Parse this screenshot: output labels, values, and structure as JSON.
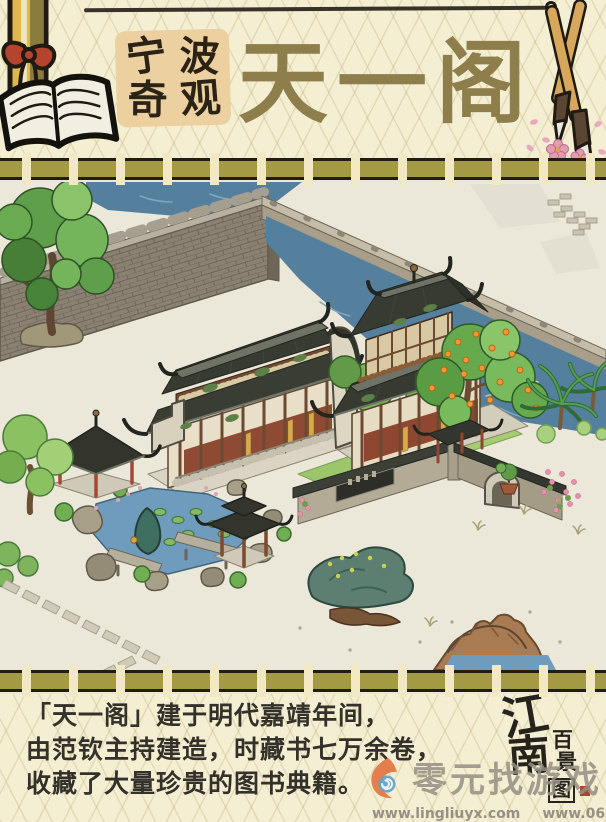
{
  "header": {
    "badge": {
      "label": "宁波奇观",
      "chars": [
        "宁",
        "波",
        "奇",
        "观"
      ],
      "bg": "#ecd0a0"
    },
    "title": "天一阁",
    "title_color": "#8d7e4c",
    "left_icon": "book-and-scroll",
    "right_icon": "calligraphy-brushes"
  },
  "divider": {
    "band_color": "#a49a44",
    "tie_color": "#f2e8c3"
  },
  "scene": {
    "subject": "天一阁",
    "water_color": "#54809e",
    "roof_color": "#383b31",
    "elements": [
      "city-wall",
      "canal",
      "stone-embankment",
      "tianyi-pavilion",
      "library-hall",
      "hexagonal-pavilion",
      "square-pavilion",
      "garden-pond",
      "lotus-pads",
      "orange-tree",
      "courtyard-tree",
      "palm-plants",
      "garden-wall",
      "arched-gate",
      "wall-plaque",
      "bonsai-pot",
      "rockery",
      "stone-paths",
      "rock-hill"
    ]
  },
  "description": {
    "lines": [
      "「天一阁」建于明代嘉靖年间，",
      "由范钦主持建造，时藏书七万余卷，",
      "收藏了大量珍贵的图书典籍。"
    ]
  },
  "logo": {
    "name": "江南百景图",
    "chars": [
      "江",
      "南",
      "百",
      "景",
      "图"
    ],
    "seal_color": "#b5422e"
  },
  "watermark": {
    "name": "零元找游戏",
    "url1": "www.lingliuyx.com",
    "url2": "www.06zyx.com"
  }
}
